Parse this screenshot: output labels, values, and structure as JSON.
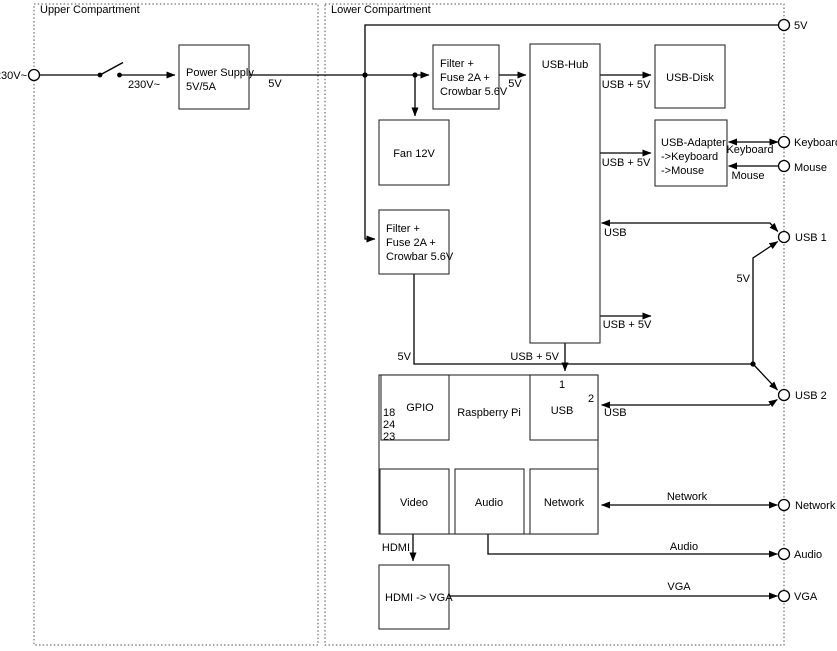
{
  "compartments": {
    "upper": "Upper Compartment",
    "lower": "Lower Compartment"
  },
  "boxes": {
    "power_supply": {
      "line1": "Power Supply",
      "line2": "5V/5A"
    },
    "filter_top": {
      "line1": "Filter +",
      "line2": "Fuse 2A +",
      "line3": "Crowbar 5.6V"
    },
    "fan": {
      "label": "Fan 12V"
    },
    "filter_mid": {
      "line1": "Filter +",
      "line2": "Fuse 2A +",
      "line3": "Crowbar 5.6V"
    },
    "usb_hub": {
      "label": "USB-Hub"
    },
    "usb_disk": {
      "label": "USB-Disk"
    },
    "usb_adapter": {
      "line1": "USB-Adapter",
      "line2": "->Keyboard",
      "line3": "->Mouse"
    },
    "raspberry_pi": {
      "label": "Raspberry Pi",
      "gpio_label": "GPIO",
      "gpio_pin1": "18",
      "gpio_pin2": "24",
      "gpio_pin3": "23",
      "usb_label": "USB",
      "usb_port1": "1",
      "usb_port2": "2",
      "video_label": "Video",
      "audio_label": "Audio",
      "network_label": "Network"
    },
    "hdmi_vga": {
      "label": "HDMI -> VGA"
    }
  },
  "terminals": {
    "mains": "230V~",
    "v5": "5V",
    "keyboard": "Keyboard",
    "mouse": "Mouse",
    "usb1": "USB 1",
    "usb2": "USB 2",
    "network": "Network",
    "audio": "Audio",
    "vga": "VGA"
  },
  "wire_labels": {
    "mains_switched": "230V~",
    "psu_out": "5V",
    "hub_in": "5V",
    "to_disk": "USB + 5V",
    "to_adapter": "USB + 5V",
    "keyboard": "Keyboard",
    "mouse": "Mouse",
    "usb1_data": "USB",
    "rail_5v": "5V",
    "spare": "USB + 5V",
    "to_pi": "USB + 5V",
    "filter_out": "5V",
    "usb2_data": "USB",
    "network": "Network",
    "audio": "Audio",
    "hdmi": "HDMI",
    "vga": "VGA"
  },
  "colors": {
    "wire": "#000000",
    "box_border": "#2d2d2d",
    "dashed_border": "#4d4d4d",
    "background": "#ffffff"
  }
}
